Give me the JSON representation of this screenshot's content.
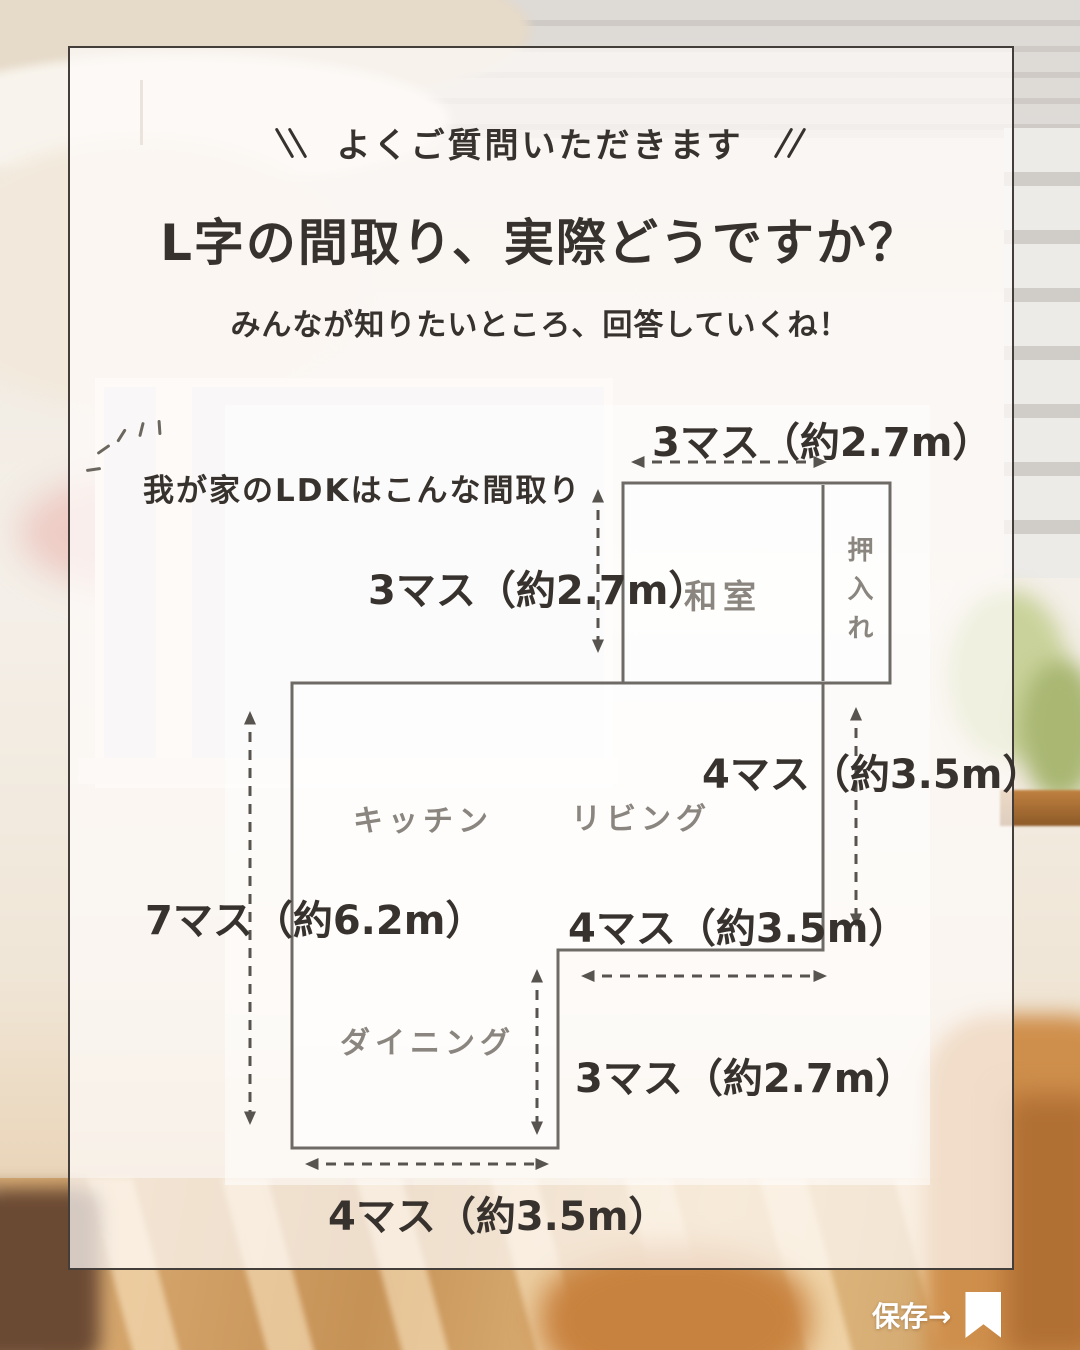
{
  "header": {
    "badge": "よくご質問いただきます",
    "title": "L字の間取り、実際どうですか？",
    "subtitle": "みんなが知りたいところ、回答していくね！"
  },
  "floorplan": {
    "caption": "我が家のLDKはこんな間取り",
    "rooms": {
      "washitsu": "和室",
      "oshiire": "押入れ",
      "kitchen": "キッチン",
      "living": "リビング",
      "dining": "ダイニング"
    },
    "dimensions": {
      "top_width": "3マス（約2.7m）",
      "washitsu_height": "3マス（約2.7m）",
      "living_height": "4マス（約3.5m）",
      "total_height": "7マス（約6.2m）",
      "living_width": "4マス（約3.5m）",
      "dining_height": "3マス（約2.7m）",
      "dining_width": "4マス（約3.5m）"
    }
  },
  "footer": {
    "save_label": "保存→"
  },
  "colors": {
    "text_dark": "#37322d",
    "room_label": "#8a857e",
    "plan_line": "#6e6a66",
    "arrow": "#57534e",
    "save_white": "#ffffff"
  }
}
